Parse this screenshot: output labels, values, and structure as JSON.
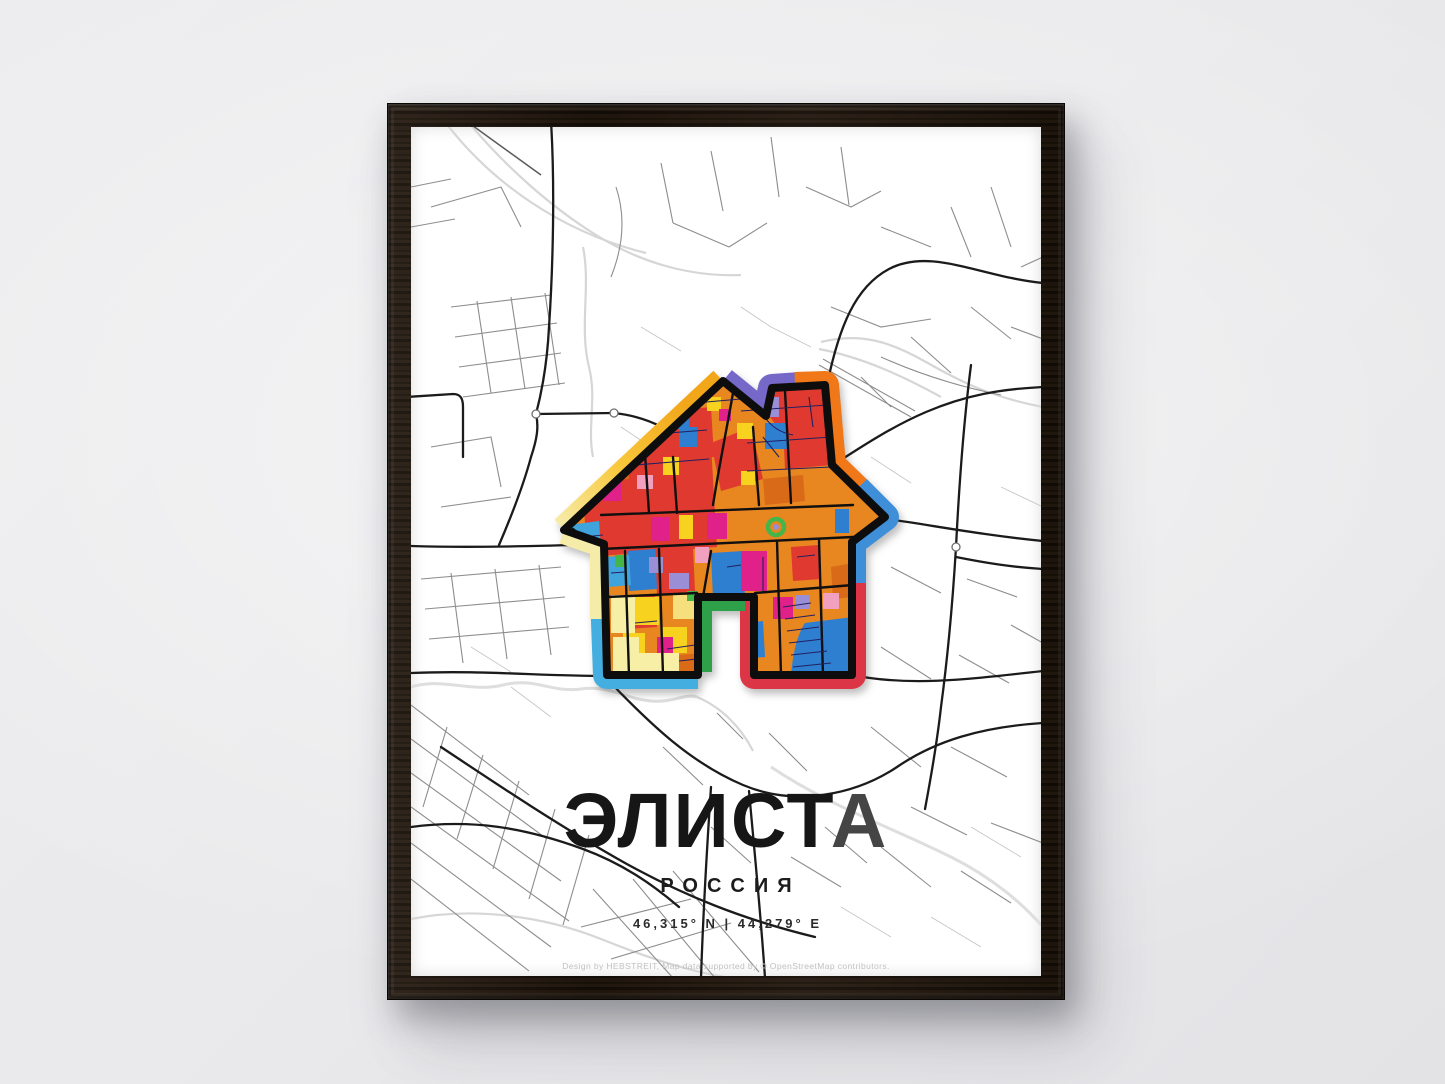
{
  "poster": {
    "title": {
      "main": "ЭЛИСТ",
      "accent": "А"
    },
    "country": "РОССИЯ",
    "coordinates": "46,315° N | 44,279° E",
    "credit": "Design by HEBSTREIT, Map data supported by © OpenStreetMap contributors.",
    "icon": "house-map-icon",
    "colors": {
      "wall": "#eaeaec",
      "frame": "#20160d",
      "posterBg": "#ffffff",
      "titleColor": "#161616",
      "titleAccent": "#454545",
      "textDark": "#2b2b2b",
      "creditColor": "#c2c2c2",
      "outlineBlack": "#0d0d0d",
      "segYellowTop": "#F2A71B",
      "segPale": "#F6ECA9",
      "segCyan": "#45AEE0",
      "segGreen": "#2FA04A",
      "segRed": "#DC3545",
      "segBlue": "#3E8FD8",
      "segOrange": "#F07818",
      "segPurple": "#7568C8",
      "mosOrange": "#E8861F",
      "mosOrangeDark": "#D96A18",
      "mosRed": "#E03A30",
      "mosBlue": "#2E7FD0",
      "mosCyan": "#3FA3DC",
      "mosYellow": "#F7D21E",
      "mosPale": "#F8EFA6",
      "mosGold": "#F6E07E",
      "mosMagenta": "#E0218A",
      "mosPink": "#F2A0C0",
      "mosPurple": "#9A8FD6",
      "mosGreen": "#45B549",
      "mosNavy": "#23205F"
    }
  }
}
